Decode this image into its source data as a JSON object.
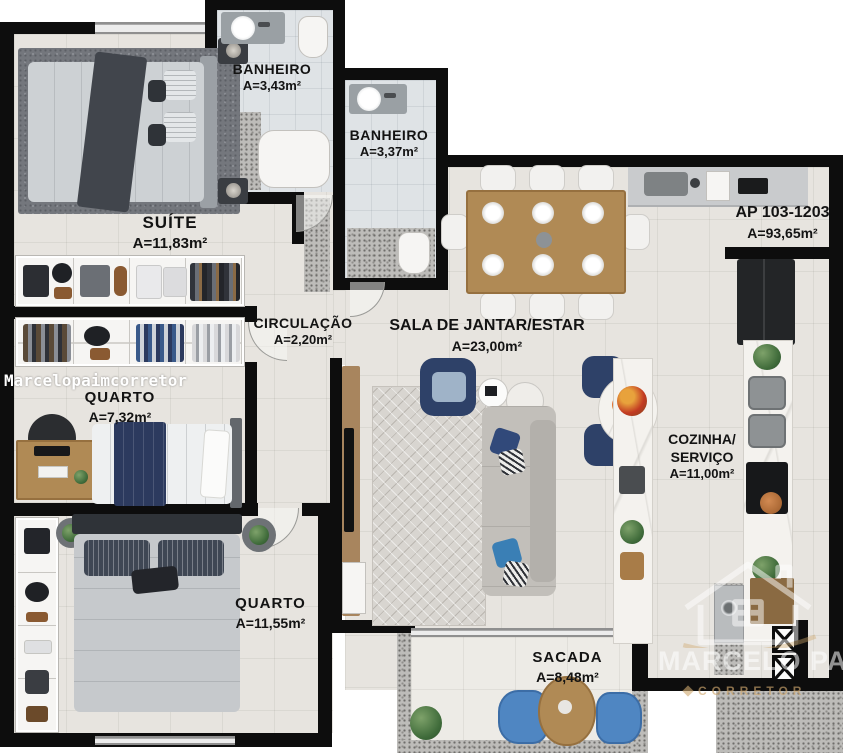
{
  "unit": {
    "code": "AP 103-1203",
    "area": "A=93,65m²"
  },
  "rooms": {
    "suite": {
      "name": "SUÍTE",
      "area": "A=11,83m²"
    },
    "banheiro_suite": {
      "name": "BANHEIRO",
      "area": "A=3,43m²"
    },
    "banheiro_social": {
      "name": "BANHEIRO",
      "area": "A=3,37m²"
    },
    "circulacao": {
      "name": "CIRCULAÇÃO",
      "area": "A=2,20m²"
    },
    "sala": {
      "name": "SALA DE JANTAR/ESTAR",
      "area": "A=23,00m²"
    },
    "quarto_1": {
      "name": "QUARTO",
      "area": "A=7,32m²"
    },
    "cozinha": {
      "name_line1": "COZINHA/",
      "name_line2": "SERVIÇO",
      "area": "A=11,00m²"
    },
    "quarto_2": {
      "name": "QUARTO",
      "area": "A=11,55m²"
    },
    "sacada": {
      "name": "SACADA",
      "area": "A=8,48m²"
    }
  },
  "watermarks": {
    "overlay_text": "Marcelopaimcorretor",
    "brand_name": "MARCELO PAIM",
    "brand_subtitle": "CORRETOR"
  },
  "colors": {
    "wall": "#0d0d0d",
    "floor": "#e7e4df",
    "bath_floor": "#dfe3e6",
    "wood": "#b08a55",
    "navy": "#2e4168",
    "sofa": "#c2bfba",
    "balcony_chair": "#4f86c2",
    "watermark": "#ffffff"
  }
}
